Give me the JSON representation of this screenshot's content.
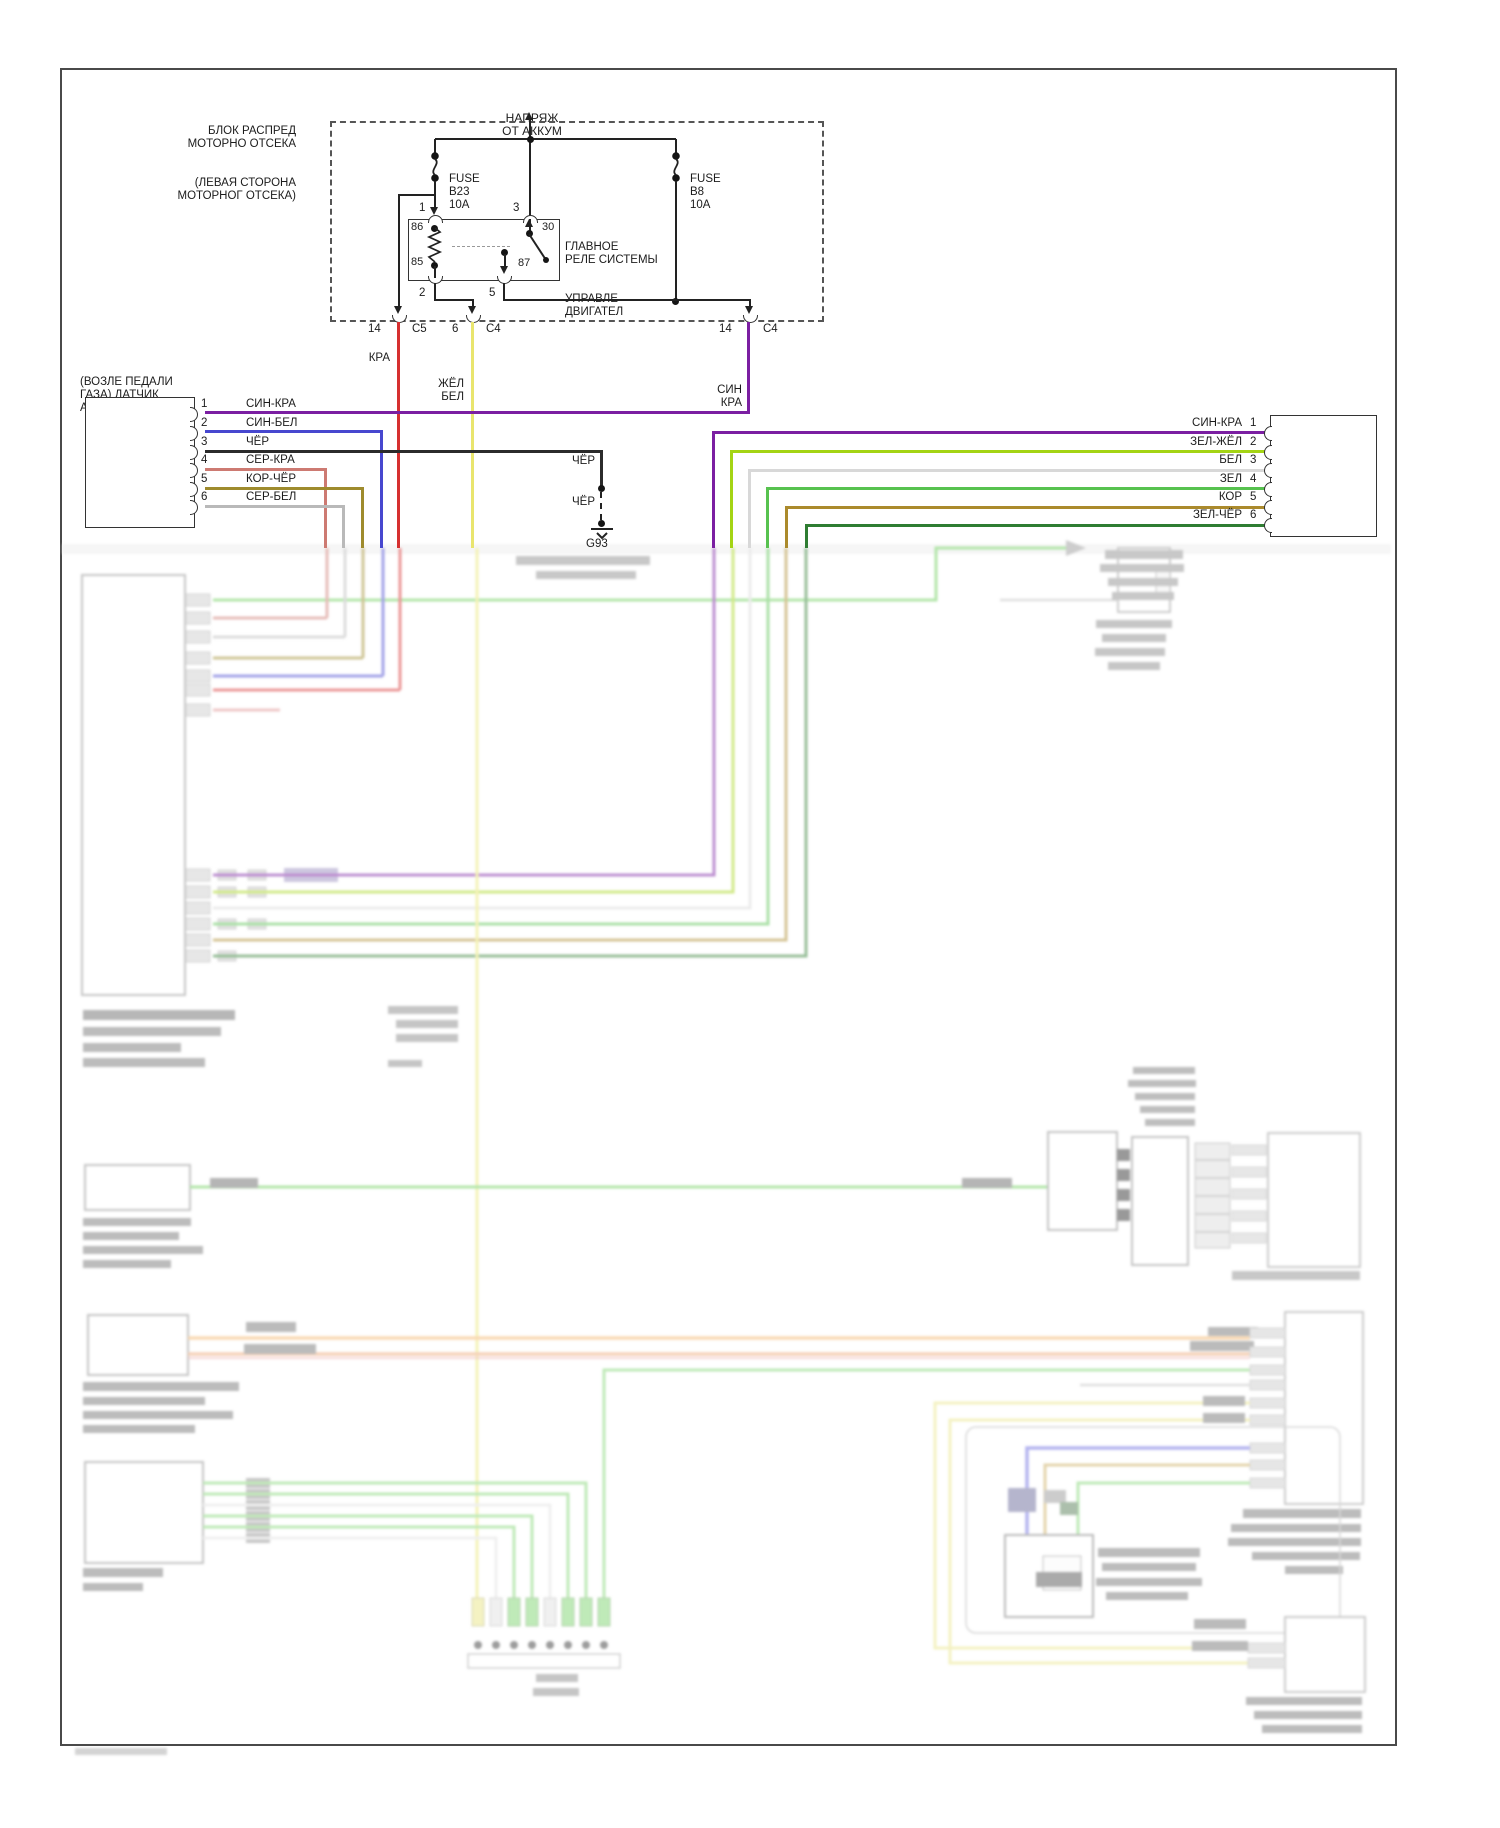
{
  "page": {
    "background": "#ffffff",
    "border_color": "#4a4a4a"
  },
  "colors": {
    "sin_kra_purple": "#7b1fa2",
    "sin_bel_blue": "#4747cf",
    "cher_black": "#2b2b2b",
    "ser_kra_salmon": "#cd7a72",
    "kor_cher_olive": "#9e8b2d",
    "ser_bel_grey": "#b9b9b9",
    "kra_red": "#d63030",
    "zhel_bel_yellow": "#e9e56e",
    "zel_zhel_chartreuse": "#a4d414",
    "bel_white": "#d8d8d8",
    "zel_green": "#57c24f",
    "kor_brown": "#ab8a2c",
    "zel_cher_darkgreen": "#2f7d32",
    "washed_green": "#66cc55",
    "washed_orange": "#f3b368"
  },
  "power": {
    "l1": "НАПРЯЖ",
    "l2": "ОТ АККУМ"
  },
  "pdb": {
    "l1": "БЛОК РАСПРЕД",
    "l2": "МОТОРНО ОТСЕКА",
    "l3": "(ЛЕВАЯ СТОРОНА",
    "l4": "МОТОРНОГ ОТСЕКА)"
  },
  "fuse_b23": {
    "l1": "FUSE",
    "l2": "B23",
    "l3": "10A"
  },
  "fuse_b8": {
    "l1": "FUSE",
    "l2": "B8",
    "l3": "10A"
  },
  "relay": {
    "name1": "ГЛАВНОЕ",
    "name2": "РЕЛЕ СИСТЕМЫ",
    "name3": "УПРАВЛЕ",
    "name4": "ДВИГАТЕЛ",
    "coil_top": "86",
    "coil_bot": "85",
    "sw_in": "30",
    "sw_out": "87",
    "pin_top_left": "1",
    "pin_top_right": "3",
    "pin_bot_left": "2",
    "pin_bot_right": "5"
  },
  "connectors": {
    "c5": {
      "pin": "14",
      "name": "C5"
    },
    "c4a": {
      "pin": "6",
      "name": "C4"
    },
    "c4b": {
      "pin": "14",
      "name": "C4"
    }
  },
  "wire_labels": {
    "kra": "КРА",
    "zhel": "ЖЁЛ",
    "bel": "БЕЛ",
    "sin": "СИН",
    "kra2": "КРА"
  },
  "accel": {
    "l1": "(ВОЗЛЕ ПЕДАЛИ",
    "l2": "ГАЗА) ДАТЧИК",
    "l3": "АКСЕЛЕРАТОРА",
    "pins": [
      {
        "n": "1",
        "label": "СИН-КРА"
      },
      {
        "n": "2",
        "label": "СИН-БЕЛ"
      },
      {
        "n": "3",
        "label": "ЧЁР"
      },
      {
        "n": "4",
        "label": "СЕР-КРА"
      },
      {
        "n": "5",
        "label": "КОР-ЧЁР"
      },
      {
        "n": "6",
        "label": "СЕР-БЕЛ"
      }
    ]
  },
  "ground": {
    "w1": "ЧЁР",
    "w2": "ЧЁР",
    "gid": "G93"
  },
  "ecm_conn": {
    "pins": [
      {
        "n": "1",
        "label": "СИН-КРА"
      },
      {
        "n": "2",
        "label": "ЗЕЛ-ЖЁЛ"
      },
      {
        "n": "3",
        "label": "БЕЛ"
      },
      {
        "n": "4",
        "label": "ЗЕЛ"
      },
      {
        "n": "5",
        "label": "КОР"
      },
      {
        "n": "6",
        "label": "ЗЕЛ-ЧЁР"
      }
    ]
  }
}
